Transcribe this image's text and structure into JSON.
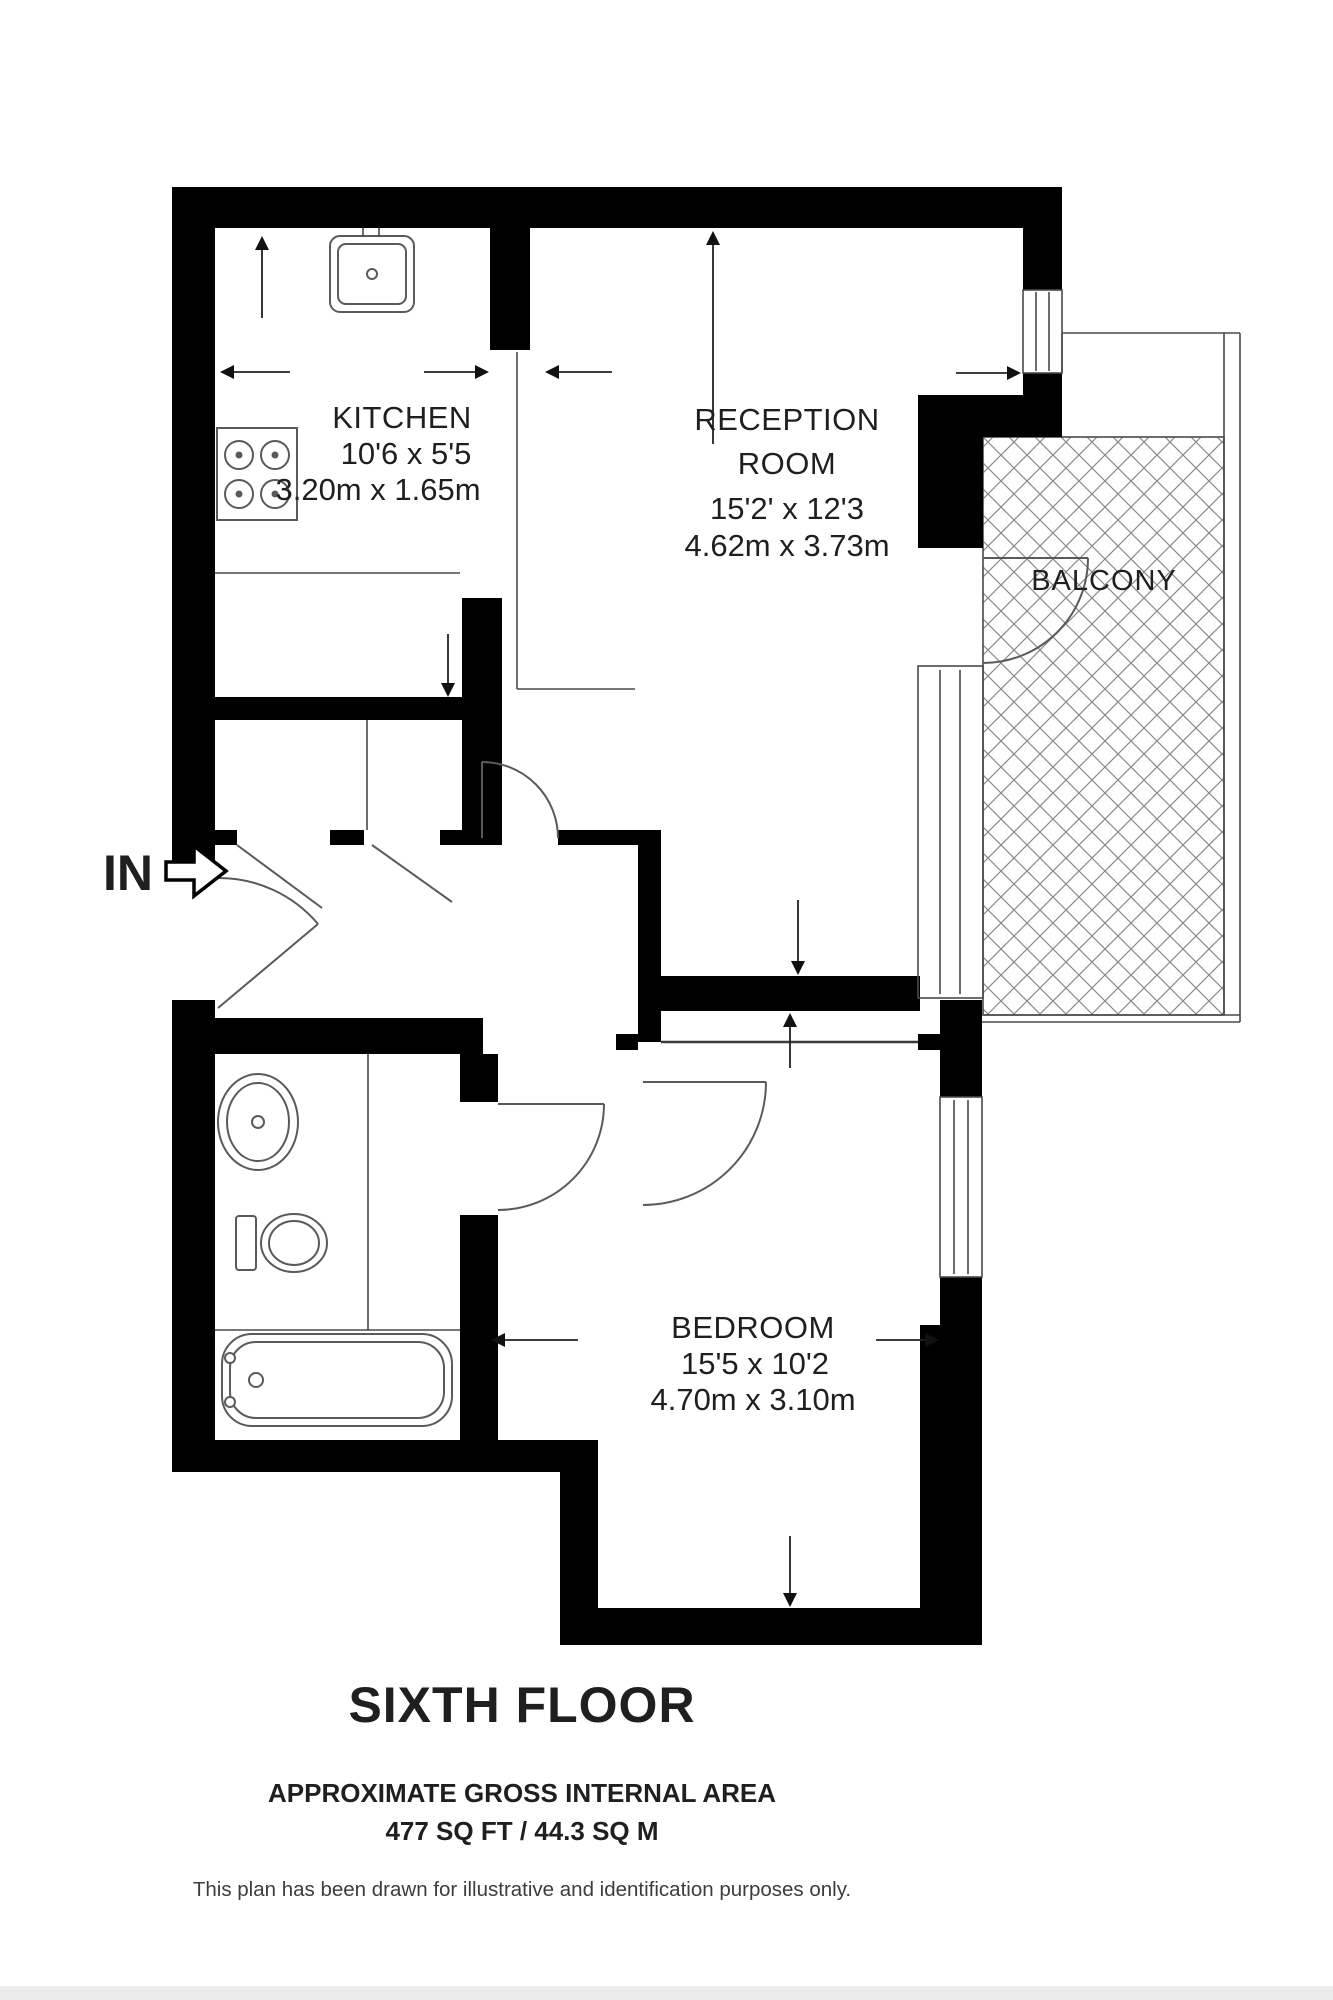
{
  "plan": {
    "entrance_label": "IN",
    "floor_title": "SIXTH FLOOR",
    "area_heading": "APPROXIMATE GROSS INTERNAL AREA",
    "area_value": "477 SQ FT / 44.3 SQ M",
    "disclaimer": "This plan has been drawn for illustrative and identification purposes only.",
    "rooms": {
      "kitchen": {
        "name": "KITCHEN",
        "imperial": "10'6 x 5'5",
        "metric": "3.20m x 1.65m"
      },
      "reception": {
        "name_line1": "RECEPTION",
        "name_line2": "ROOM",
        "imperial": "15'2' x 12'3",
        "metric": "4.62m x 3.73m"
      },
      "bedroom": {
        "name": "BEDROOM",
        "imperial": "15'5 x 10'2",
        "metric": "4.70m x 3.10m"
      },
      "balcony": {
        "name": "BALCONY"
      }
    },
    "colors": {
      "wall": "#000000",
      "line": "#4a4a4a",
      "text": "#1f1f1f"
    }
  }
}
